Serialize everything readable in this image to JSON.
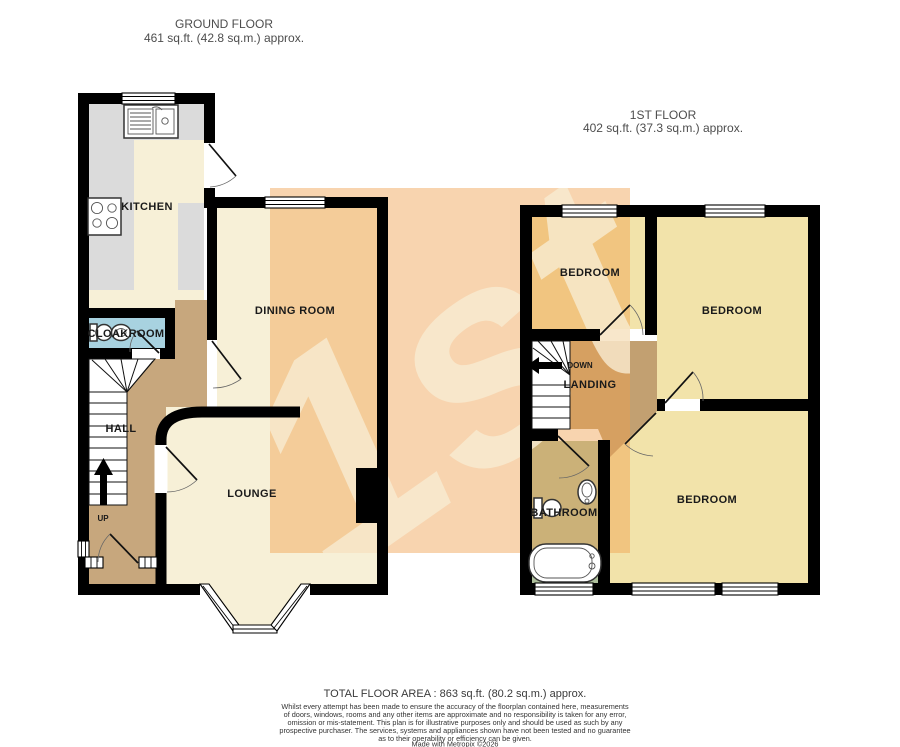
{
  "ground_floor": {
    "title": "GROUND FLOOR",
    "area": "461 sq.ft. (42.8 sq.m.) approx.",
    "rooms": {
      "kitchen": "KITCHEN",
      "cloakroom": "CLOAKROOM",
      "hall": "HALL",
      "dining": "DINING ROOM",
      "lounge": "LOUNGE"
    },
    "stairs_label": "UP"
  },
  "first_floor": {
    "title": "1ST FLOOR",
    "area": "402 sq.ft. (37.3 sq.m.) approx.",
    "rooms": {
      "bedroom_front": "BEDROOM",
      "bedroom_back": "BEDROOM",
      "bedroom_large": "BEDROOM",
      "landing": "LANDING",
      "bathroom": "BATHROOM"
    },
    "stairs_label": "DOWN"
  },
  "watermark": {
    "text": "1st"
  },
  "footer": {
    "total_area": "TOTAL FLOOR AREA : 863 sq.ft. (80.2 sq.m.) approx.",
    "disclaimer_lines": [
      "Whilst every attempt has been made to ensure the accuracy of the floorplan contained here, measurements",
      "of doors, windows, rooms and any other items are approximate and no responsibility is taken for any error,",
      "omission or mis-statement. This plan is for illustrative purposes only and should be used as such by any",
      "prospective purchaser. The services, systems and appliances shown have not been tested and no guarantee",
      "as to their operability or efficiency can be given.",
      "Made with Metropix ©2026"
    ]
  },
  "colors": {
    "wall_black": "#000000",
    "floor_cream": "#f7f0d7",
    "bedroom_yellow": "#f2e3aa",
    "hall_tan": "#c7a77d",
    "landing_tan": "#c2a071",
    "cloakroom_blue": "#a8d2e0",
    "bathroom_green": "#aec09c",
    "counter_gray": "#dbdbdb",
    "watermark_orange": "#ef9f4e",
    "watermark_letters": "#f8ecd2"
  }
}
